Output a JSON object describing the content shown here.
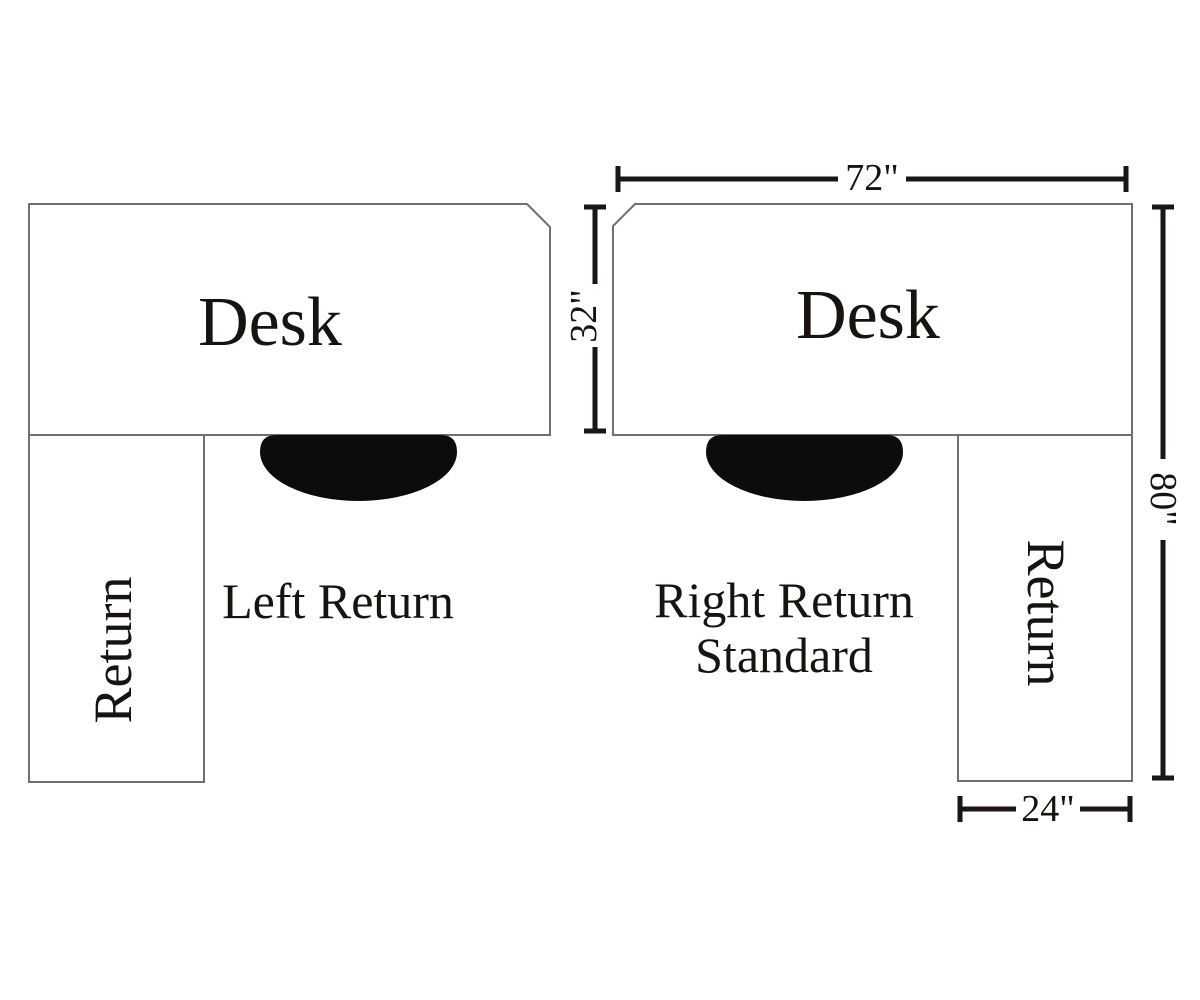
{
  "diagram": {
    "left_unit": {
      "desk_label": "Desk",
      "return_label": "Return",
      "caption": "Left Return"
    },
    "right_unit": {
      "desk_label": "Desk",
      "return_label": "Return",
      "caption_line1": "Right Return",
      "caption_line2": "Standard"
    },
    "dimensions": {
      "desk_width": "72\"",
      "desk_depth": "32\"",
      "overall_depth": "80\"",
      "return_width": "24\""
    },
    "colors": {
      "background": "#ffffff",
      "surface_outline": "#707070",
      "dimension_lines": "#191613",
      "text": "#17130f",
      "chair_fill": "#0e0c0a"
    }
  }
}
